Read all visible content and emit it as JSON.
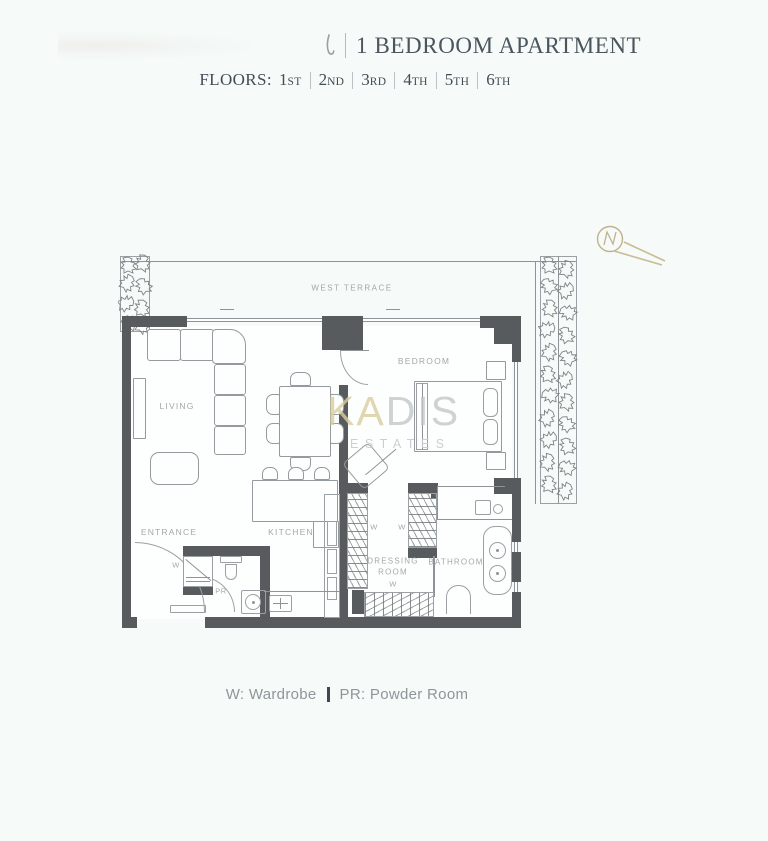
{
  "header": {
    "title": "1 BEDROOM APARTMENT",
    "floors_label": "FLOORS:",
    "floors": [
      {
        "num": "1",
        "suf": "st"
      },
      {
        "num": "2",
        "suf": "nd"
      },
      {
        "num": "3",
        "suf": "rd"
      },
      {
        "num": "4",
        "suf": "th"
      },
      {
        "num": "5",
        "suf": "th"
      },
      {
        "num": "6",
        "suf": "th"
      }
    ]
  },
  "plan": {
    "terrace_label": "WEST TERRACE",
    "rooms": {
      "living": "LIVING",
      "bedroom": "BEDROOM",
      "entrance": "ENTRANCE",
      "kitchen": "KITCHEN",
      "dressing_line1": "DRESSING",
      "dressing_line2": "ROOM",
      "bathroom": "BATHROOM"
    },
    "abbr": {
      "wardrobe": "W",
      "powder_room": "PR"
    },
    "watermark": {
      "name_accent": "KA",
      "name_rest": "DIS",
      "subtitle": "ESTATES"
    }
  },
  "legend": {
    "wardrobe": "W: Wardrobe",
    "powder_room": "PR: Powder Room"
  },
  "colors": {
    "background": "#f6faf8",
    "wall": "#575b5e",
    "line": "#8d9396",
    "label": "#a2a8aa",
    "gold": "#c2b28a",
    "title_text": "#4b555e"
  }
}
